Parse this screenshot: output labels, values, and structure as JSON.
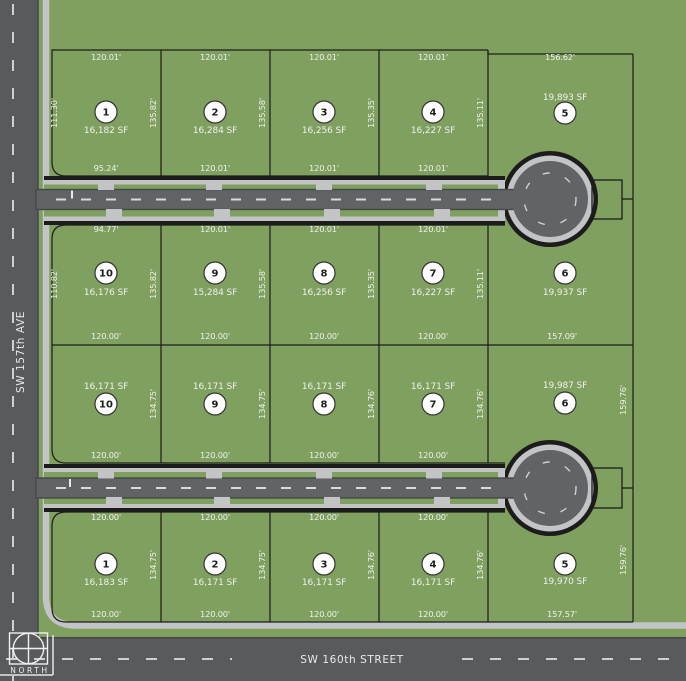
{
  "map": {
    "north_label": "NORTH",
    "streets": {
      "left_avenue": "SW 157th AVE",
      "bottom_street": "SW 160th STREET"
    },
    "colors": {
      "grass_green": "#7fa05e",
      "street_asphalt": "#595a5e",
      "road_asphalt": "#626367",
      "sidewalk_gray": "#c3c4c6",
      "outline_dark": "#1c1c1c",
      "lane_dash_white": "#d9dadc",
      "lot_circle_fill": "#fdfdfd"
    },
    "rows": [
      {
        "name": "north block, row 1",
        "lots": [
          {
            "number": "1",
            "sf": "16,182 SF",
            "dims": {
              "top": "120.01'",
              "bottom": "95.24'",
              "left": "111.30'",
              "right": "135.82'"
            }
          },
          {
            "number": "2",
            "sf": "16,284 SF",
            "dims": {
              "top": "120.01'",
              "bottom": "120.01'",
              "right": "135.58'"
            }
          },
          {
            "number": "3",
            "sf": "16,256 SF",
            "dims": {
              "top": "120.01'",
              "bottom": "120.01'",
              "right": "135.35'"
            }
          },
          {
            "number": "4",
            "sf": "16,227 SF",
            "dims": {
              "top": "120.01'",
              "bottom": "120.01'",
              "right": "135.11'"
            }
          },
          {
            "number": "5",
            "sf": "19,893 SF",
            "dims": {
              "top": "156.62'"
            }
          }
        ]
      },
      {
        "name": "middle block, upper row",
        "lots": [
          {
            "number": "10",
            "sf": "16,176 SF",
            "dims": {
              "top": "94.77'",
              "bottom": "120.00'",
              "left": "110.82'",
              "right": "135.82'"
            }
          },
          {
            "number": "9",
            "sf": "15,284 SF",
            "dims": {
              "top": "120.01'",
              "bottom": "120.00'",
              "right": "135.58'"
            }
          },
          {
            "number": "8",
            "sf": "16,256 SF",
            "dims": {
              "top": "120.01'",
              "bottom": "120.00'",
              "right": "135.35'"
            }
          },
          {
            "number": "7",
            "sf": "16,227 SF",
            "dims": {
              "top": "120.01'",
              "bottom": "120.00'",
              "right": "135.11'"
            }
          },
          {
            "number": "6",
            "sf": "19,937 SF",
            "dims": {
              "bottom": "157.09'"
            }
          }
        ]
      },
      {
        "name": "middle block, lower row",
        "lots": [
          {
            "number": "10",
            "sf": "16,171 SF",
            "dims": {
              "bottom": "120.00'",
              "right": "134.75'"
            }
          },
          {
            "number": "9",
            "sf": "16,171 SF",
            "dims": {
              "bottom": "120.00'",
              "right": "134.75'"
            }
          },
          {
            "number": "8",
            "sf": "16,171 SF",
            "dims": {
              "bottom": "120.00'",
              "right": "134.76'"
            }
          },
          {
            "number": "7",
            "sf": "16,171 SF",
            "dims": {
              "bottom": "120.00'",
              "right": "134.76'"
            }
          },
          {
            "number": "6",
            "sf": "19,987 SF",
            "dims": {
              "right": "159.76'"
            }
          }
        ]
      },
      {
        "name": "south block, row 4",
        "lots": [
          {
            "number": "1",
            "sf": "16,183 SF",
            "dims": {
              "top": "120.00'",
              "bottom": "120.00'",
              "right": "134.75'"
            }
          },
          {
            "number": "2",
            "sf": "16,171 SF",
            "dims": {
              "top": "120.00'",
              "bottom": "120.00'",
              "right": "134.75'"
            }
          },
          {
            "number": "3",
            "sf": "16,171 SF",
            "dims": {
              "top": "120.00'",
              "bottom": "120.00'",
              "right": "134.76'"
            }
          },
          {
            "number": "4",
            "sf": "16,171 SF",
            "dims": {
              "top": "120.00'",
              "bottom": "120.00'",
              "right": "134.76'"
            }
          },
          {
            "number": "5",
            "sf": "19,970 SF",
            "dims": {
              "bottom": "157.57'",
              "right": "159.76'"
            }
          }
        ]
      }
    ]
  }
}
